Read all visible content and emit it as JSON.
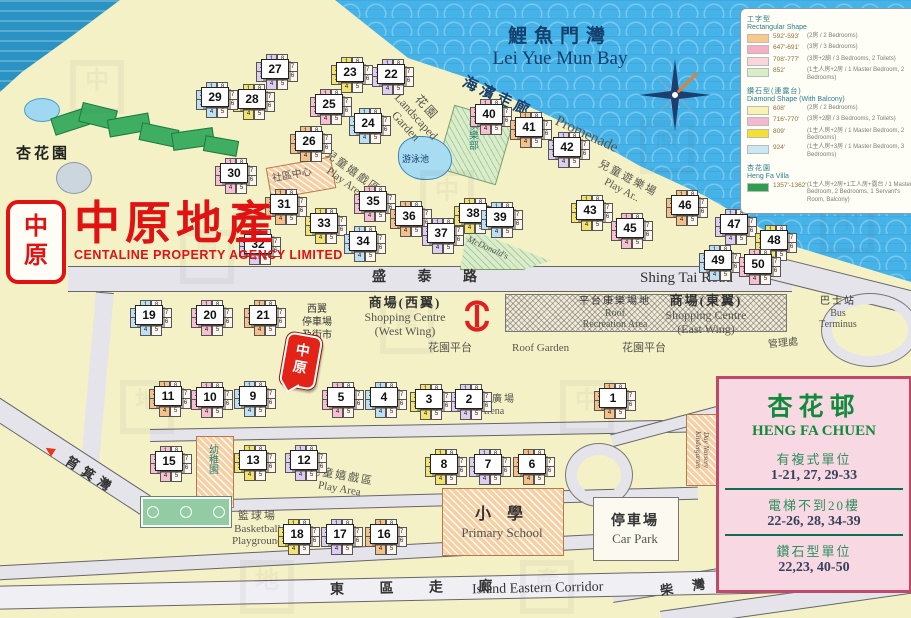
{
  "brand": {
    "seal_top": "中",
    "seal_bottom": "原",
    "name_zh": "中原地產",
    "name_en": "CENTALINE PROPERTY AGENCY LIMITED"
  },
  "labels": {
    "bay_zh": "鯉魚門灣",
    "bay_en": "Lei Yue Mun Bay",
    "promenade_zh": "海 濱 走 廊",
    "promenade_en": "Promenade",
    "landscaped_zh": "花園",
    "landscaped_en1": "Landscaped",
    "landscaped_en2": "Garden",
    "play_nw_zh": "兒童嬉戲區",
    "play_nw_en": "Play Area",
    "play_ne_zh": "兒童遊樂場",
    "play_ne_en": "Play Ar..",
    "play_s_zh": "兒童嬉戲區",
    "play_s_en": "Play Area",
    "club": "俱樂部",
    "pool": "游泳池",
    "community": "社區中心",
    "mcdonalds": "McDonald's",
    "villa": "杏花園",
    "west_market1": "西翼",
    "west_market2": "停車場",
    "west_market3": "及街市",
    "shop_w_zh": "商場(西翼)",
    "shop_w_en1": "Shopping Centre",
    "shop_w_en2": "(West Wing)",
    "roof_rec_zh": "平台康樂場地",
    "roof_rec_en1": "Roof",
    "roof_rec_en2": "Recreation Area",
    "shop_e_zh": "商場(東翼)",
    "shop_e_en1": "Shopping Centre",
    "shop_e_en2": "(East Wing)",
    "bus_zh": "巴士站",
    "bus_en1": "Bus",
    "bus_en2": "Terminus",
    "mgmt": "管理處",
    "roof_garden_w": "花園平台",
    "roof_garden_en": "Roof Garden",
    "roof_garden_e": "花園平台",
    "arena_zh": "圓形廣場",
    "arena_en": "Arena",
    "kindergarten": "幼稚園",
    "nursery": "Day Nursery Kindergarten",
    "basketball_zh": "籃球場",
    "basketball_en1": "Basketball",
    "basketball_en2": "Playground",
    "school_zh": "小 學",
    "school_en": "Primary School",
    "carpark_zh": "停車場",
    "carpark_en": "Car Park",
    "shing_tai_zh": "盛 泰 路",
    "shing_tai_en": "Shing Tai Road",
    "corridor_zh": "東 區 走 廊",
    "corridor_en": "Island Eastern Corridor",
    "shau_kei_wan": "筲箕灣",
    "chai_wan_1": "柴 灣",
    "chai_wan_2": "柴 灣",
    "arrow": "▶",
    "arrow_left": "◀"
  },
  "legend": {
    "sections": [
      {
        "title_zh": "工字型",
        "title_en": "Rectangular Shape",
        "rows": [
          {
            "swatch": "#f9c88a",
            "area": "592'-593'",
            "desc": "(2房 / 2 Bedrooms)"
          },
          {
            "swatch": "#f6aec6",
            "area": "647'-691'",
            "desc": "(3房 / 3 Bedrooms)"
          },
          {
            "swatch": "#fbd4dc",
            "area": "708'-777'",
            "desc": "(3房+2廁 / 3 Bedrooms, 2 Toilets)"
          },
          {
            "swatch": "#d8eec8",
            "area": "852'",
            "desc": "(1主人房+2房 / 1 Master Bedroom, 2 Bedrooms)"
          }
        ]
      },
      {
        "title_zh": "鑽石型(連露台)",
        "title_en": "Diamond Shape (With Balcony)",
        "rows": [
          {
            "swatch": "#f8f3b0",
            "area": "608'",
            "desc": "(2房 / 2 Bedrooms)"
          },
          {
            "swatch": "#f4b8d0",
            "area": "716'-770'",
            "desc": "(3房+2廁 / 3 Bedrooms, 2 Toilets)"
          },
          {
            "swatch": "#f5e030",
            "area": "809'",
            "desc": "(1主人房+2房 / 1 Master Bedroom, 2 Bedrooms)"
          },
          {
            "swatch": "#c8e8f4",
            "area": "924'",
            "desc": "(1主人房+3房 / 1 Master Bedroom, 3 Bedrooms)"
          }
        ]
      },
      {
        "title_zh": "杏花園",
        "title_en": "Heng Fa Villa",
        "rows": [
          {
            "swatch": "#2e9e50",
            "area": "1357'-1362'",
            "desc": "(1主人房+2房+1工人房+露台 / 1 Master Bedroom, 2 Bedrooms, 1 Servant's Room, Balcony)"
          }
        ]
      }
    ]
  },
  "info_box": {
    "title_zh": "杏花邨",
    "title_en": "HENG FA CHUEN",
    "rows": [
      {
        "label": "有複式單位",
        "value": "1-21, 27, 29-33"
      },
      {
        "label": "電梯不到20樓",
        "value": "22-26, 28, 34-39"
      },
      {
        "label": "鑽石型單位",
        "value": "22,23, 40-50"
      }
    ]
  },
  "map": {
    "tower_palette": [
      "#f7bfd2",
      "#f6c08a",
      "#ddcdf0",
      "#f3e372",
      "#bfe0f4"
    ],
    "unit_numbers": [
      "1",
      "8",
      "2",
      "7",
      "3",
      "6",
      "4",
      "5"
    ],
    "towers": [
      {
        "n": 1,
        "x": 612,
        "y": 397
      },
      {
        "n": 2,
        "x": 468,
        "y": 398
      },
      {
        "n": 3,
        "x": 428,
        "y": 398
      },
      {
        "n": 4,
        "x": 383,
        "y": 396
      },
      {
        "n": 5,
        "x": 340,
        "y": 396
      },
      {
        "n": 6,
        "x": 531,
        "y": 463
      },
      {
        "n": 7,
        "x": 487,
        "y": 463
      },
      {
        "n": 8,
        "x": 443,
        "y": 463
      },
      {
        "n": 9,
        "x": 252,
        "y": 395
      },
      {
        "n": 10,
        "x": 209,
        "y": 396
      },
      {
        "n": 11,
        "x": 167,
        "y": 395
      },
      {
        "n": 12,
        "x": 303,
        "y": 459
      },
      {
        "n": 13,
        "x": 252,
        "y": 459
      },
      {
        "n": 15,
        "x": 168,
        "y": 460
      },
      {
        "n": 16,
        "x": 383,
        "y": 533
      },
      {
        "n": 17,
        "x": 339,
        "y": 533
      },
      {
        "n": 18,
        "x": 296,
        "y": 533
      },
      {
        "n": 19,
        "x": 148,
        "y": 314
      },
      {
        "n": 20,
        "x": 209,
        "y": 314
      },
      {
        "n": 21,
        "x": 262,
        "y": 314
      },
      {
        "n": 22,
        "x": 390,
        "y": 73
      },
      {
        "n": 23,
        "x": 349,
        "y": 71
      },
      {
        "n": 24,
        "x": 367,
        "y": 122
      },
      {
        "n": 25,
        "x": 328,
        "y": 103
      },
      {
        "n": 26,
        "x": 308,
        "y": 140
      },
      {
        "n": 27,
        "x": 274,
        "y": 68
      },
      {
        "n": 28,
        "x": 251,
        "y": 98
      },
      {
        "n": 29,
        "x": 214,
        "y": 96
      },
      {
        "n": 30,
        "x": 233,
        "y": 172
      },
      {
        "n": 31,
        "x": 283,
        "y": 203
      },
      {
        "n": 32,
        "x": 257,
        "y": 243
      },
      {
        "n": 33,
        "x": 323,
        "y": 222
      },
      {
        "n": 34,
        "x": 362,
        "y": 240
      },
      {
        "n": 35,
        "x": 372,
        "y": 200
      },
      {
        "n": 36,
        "x": 408,
        "y": 215
      },
      {
        "n": 37,
        "x": 440,
        "y": 232
      },
      {
        "n": 38,
        "x": 472,
        "y": 212
      },
      {
        "n": 39,
        "x": 499,
        "y": 216
      },
      {
        "n": 40,
        "x": 488,
        "y": 113
      },
      {
        "n": 41,
        "x": 528,
        "y": 126
      },
      {
        "n": 42,
        "x": 566,
        "y": 146
      },
      {
        "n": 43,
        "x": 589,
        "y": 209
      },
      {
        "n": 45,
        "x": 629,
        "y": 227
      },
      {
        "n": 46,
        "x": 684,
        "y": 204
      },
      {
        "n": 47,
        "x": 733,
        "y": 223
      },
      {
        "n": 48,
        "x": 773,
        "y": 239
      },
      {
        "n": 49,
        "x": 717,
        "y": 259
      },
      {
        "n": 50,
        "x": 757,
        "y": 263
      }
    ]
  }
}
